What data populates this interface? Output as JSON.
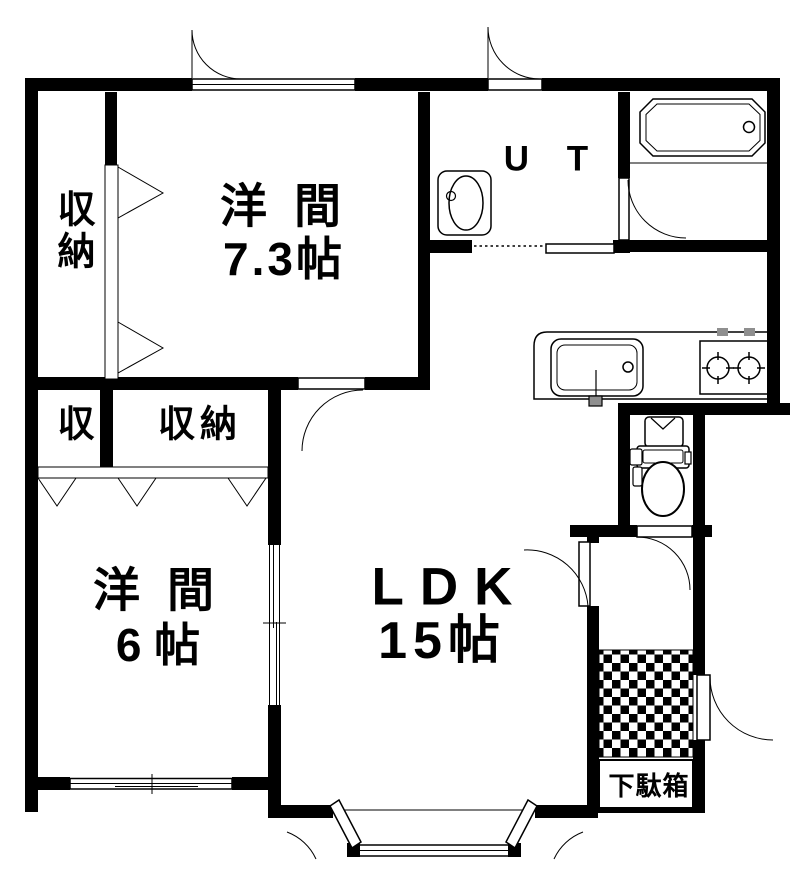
{
  "plan": {
    "title": "apartment floor plan",
    "colors": {
      "line": "#000000",
      "background": "#ffffff",
      "knob_gray": "#8f8f8f"
    },
    "labels": {
      "western_room_73": {
        "name": "洋 間",
        "size": "7.3帖"
      },
      "western_room_6": {
        "name": "洋 間",
        "size": "6 帖"
      },
      "ldk": {
        "name": "LDK",
        "size": "15帖"
      },
      "utility": {
        "label": "U T"
      },
      "closet_vertical": {
        "label": "収納"
      },
      "closet_small": {
        "label": "収"
      },
      "closet_wide": {
        "label": "収納"
      },
      "shoe_cabinet": {
        "label": "下駄箱"
      }
    },
    "icons": {
      "bathtub": "bathtub-icon",
      "washbasin": "washbasin-icon",
      "toilet": "toilet-icon",
      "kitchen_sink": "kitchen-sink-icon",
      "gas_stove": "gas-stove-icon",
      "entrance_tile": "checker-tile-floor",
      "folding_door": "folding-door-triangle",
      "swing_door": "door-swing-arc",
      "sliding_door": "sliding-door-lines",
      "window": "sliding-window-lines"
    }
  }
}
